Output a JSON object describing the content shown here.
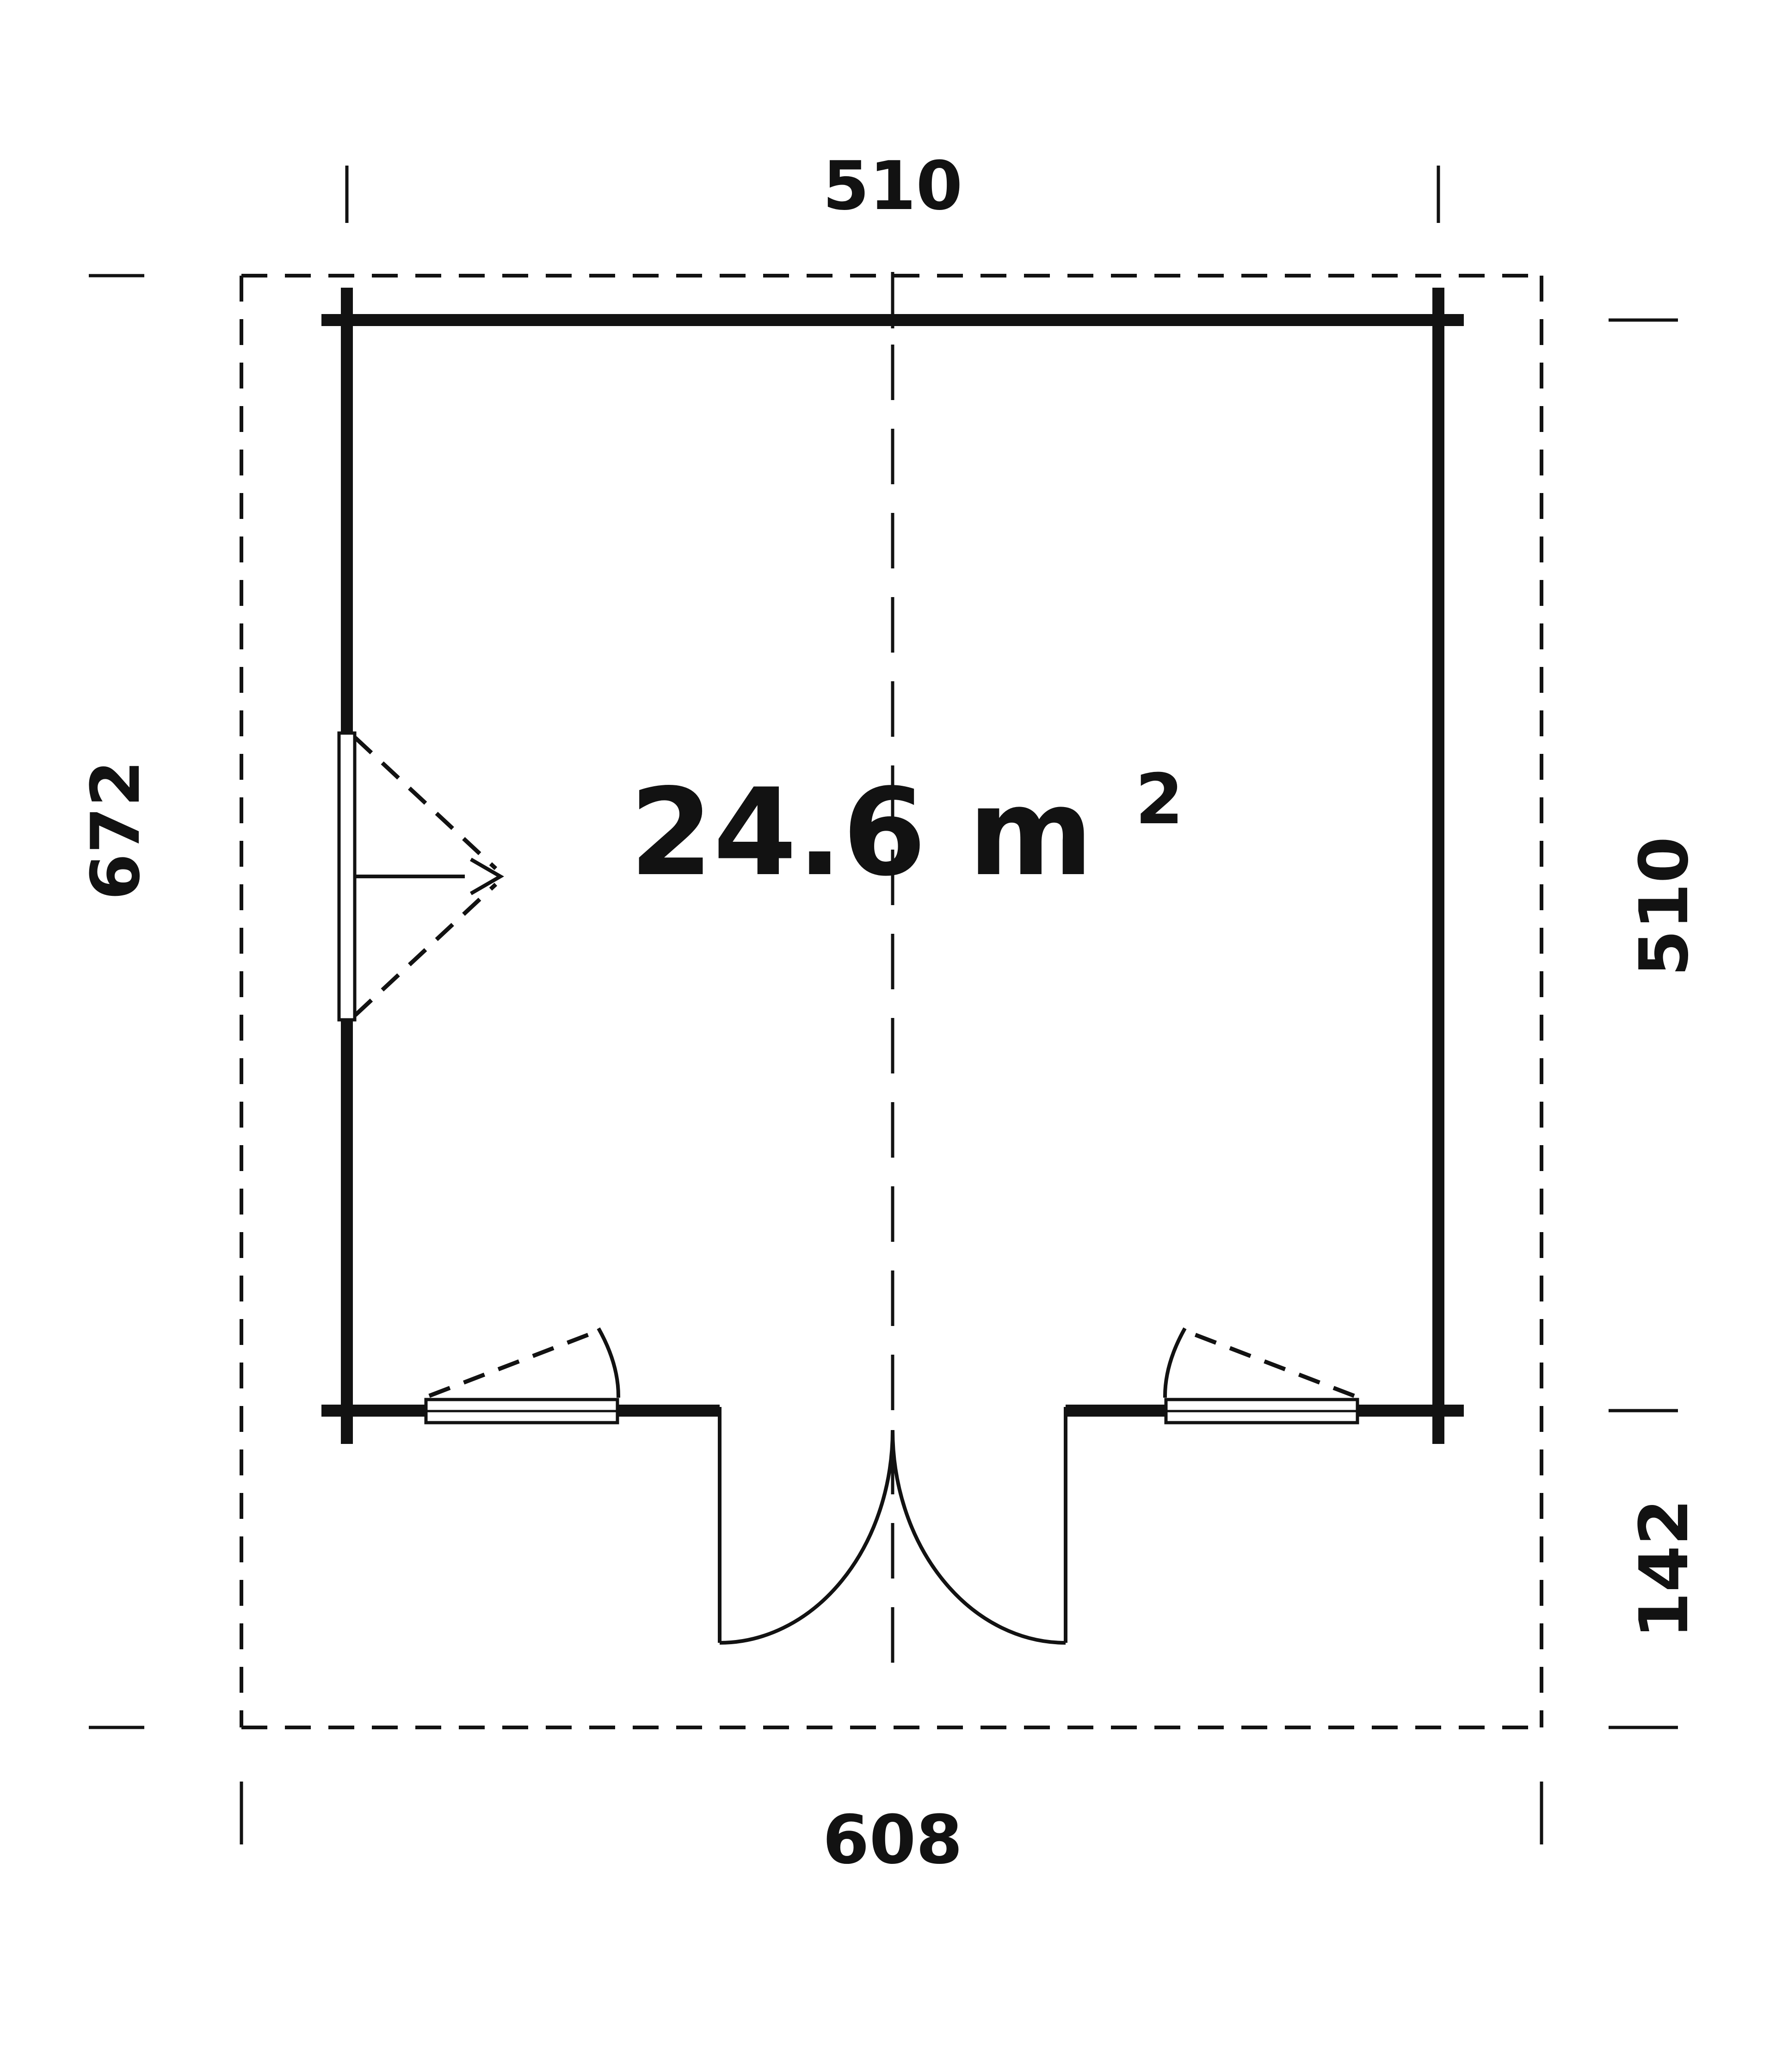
{
  "colors": {
    "ink": "#121212",
    "background": "#ffffff"
  },
  "plan": {
    "area_label": {
      "text": "24.6 m²",
      "main": "24.6 m",
      "superscript": "2"
    },
    "dimensions": {
      "top_width": "510",
      "left_overall_depth": "672",
      "right_wall_depth": "510",
      "front_overhang_depth": "142",
      "bottom_overall_width": "608"
    }
  }
}
